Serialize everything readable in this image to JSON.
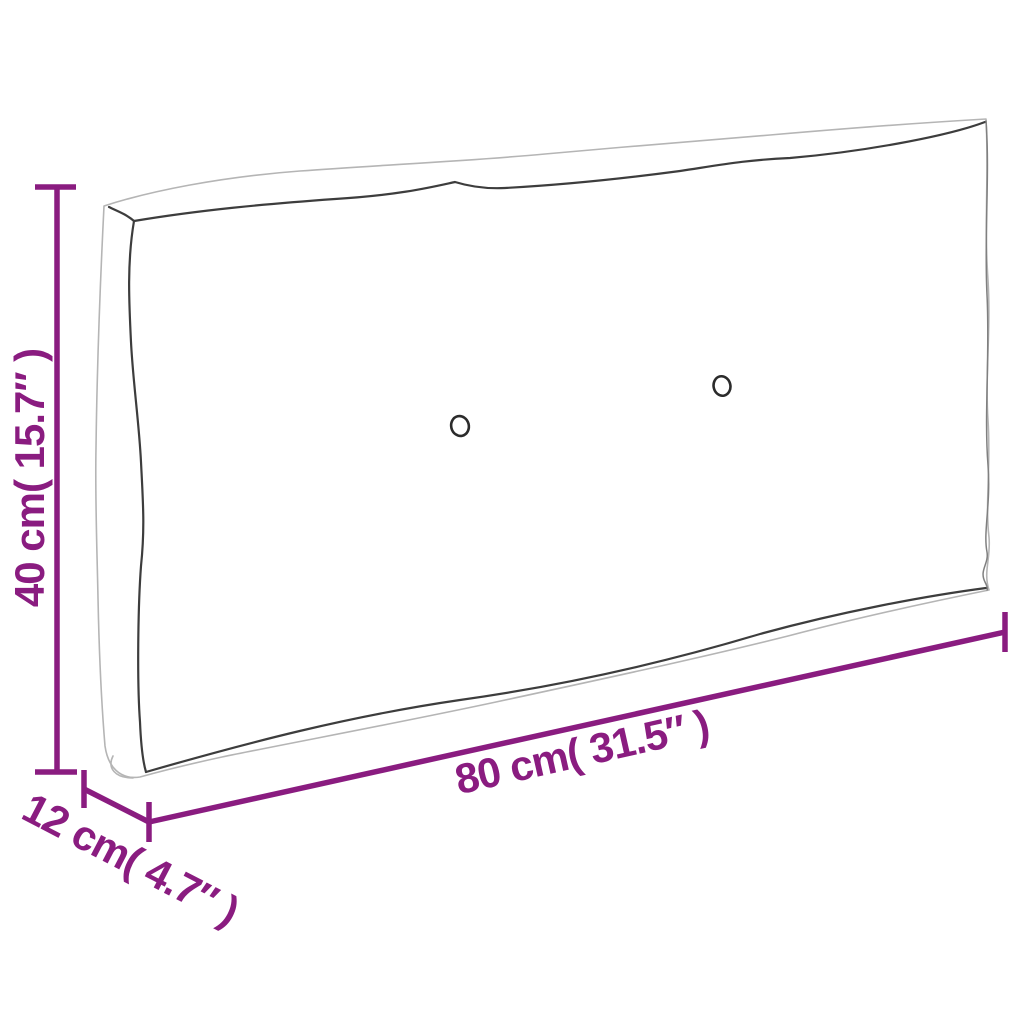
{
  "figure": {
    "type": "product-dimension-diagram",
    "subject": "pallet cushion line drawing, angled view",
    "tufting_buttons": 2
  },
  "labels": {
    "height": "40 cm( 15.7″ )",
    "length": "80 cm( 31.5″ )",
    "depth": "12 cm( 4.7″ )"
  },
  "colors": {
    "dimension_accent": "#8A1C80",
    "outline_dark": "#3d3d3d",
    "outline_light": "#b5b5b5",
    "background": "#ffffff"
  }
}
